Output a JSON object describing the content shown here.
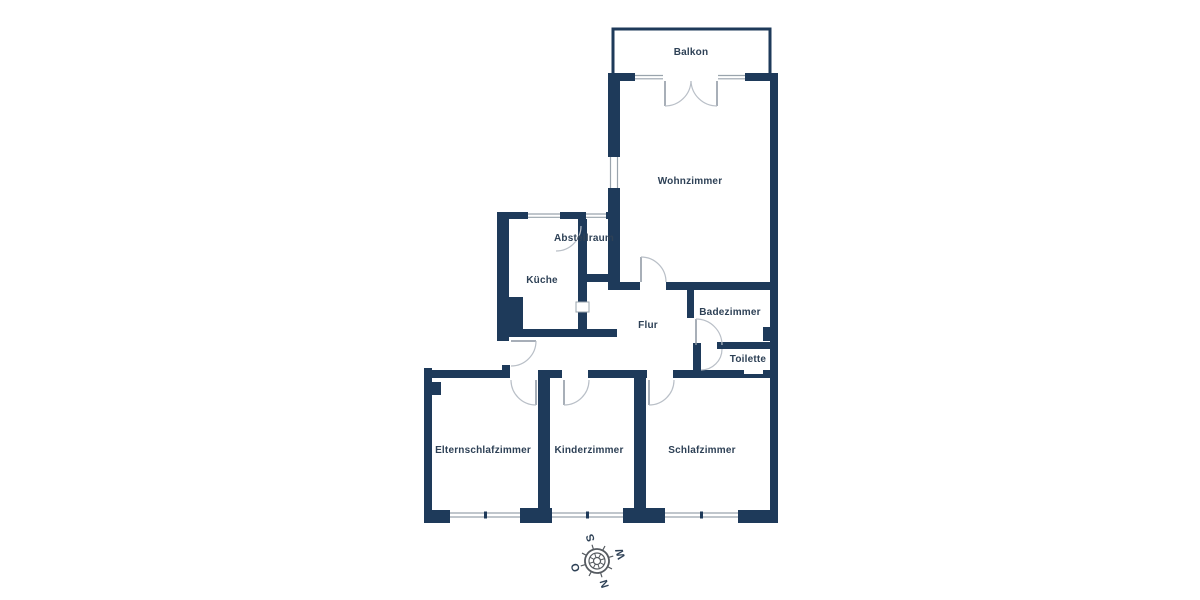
{
  "floorplan": {
    "title": "Apartment floor plan",
    "rooms": [
      {
        "id": "balkon",
        "name": "Balkon"
      },
      {
        "id": "wohnzimmer",
        "name": "Wohnzimmer"
      },
      {
        "id": "abstellraum",
        "name": "Abstellraum"
      },
      {
        "id": "kueche",
        "name": "Küche"
      },
      {
        "id": "flur",
        "name": "Flur"
      },
      {
        "id": "badezimmer",
        "name": "Badezimmer"
      },
      {
        "id": "toilette",
        "name": "Toilette"
      },
      {
        "id": "elternschlafzimmer",
        "name": "Elternschlafzimmer"
      },
      {
        "id": "kinderzimmer",
        "name": "Kinderzimmer"
      },
      {
        "id": "schlafzimmer",
        "name": "Schlafzimmer"
      }
    ],
    "compass": {
      "north": "N",
      "east": "O",
      "south": "S",
      "west": "W",
      "rotation_deg": -107
    },
    "colors": {
      "wall": "#1e3a5a",
      "label_text": "#2e4156",
      "door_leaf": "#8a94a0",
      "door_arc": "#b9bfc7",
      "window_line": "#9aa4ad",
      "compass_outline": "#555a60",
      "background": "#ffffff"
    }
  }
}
